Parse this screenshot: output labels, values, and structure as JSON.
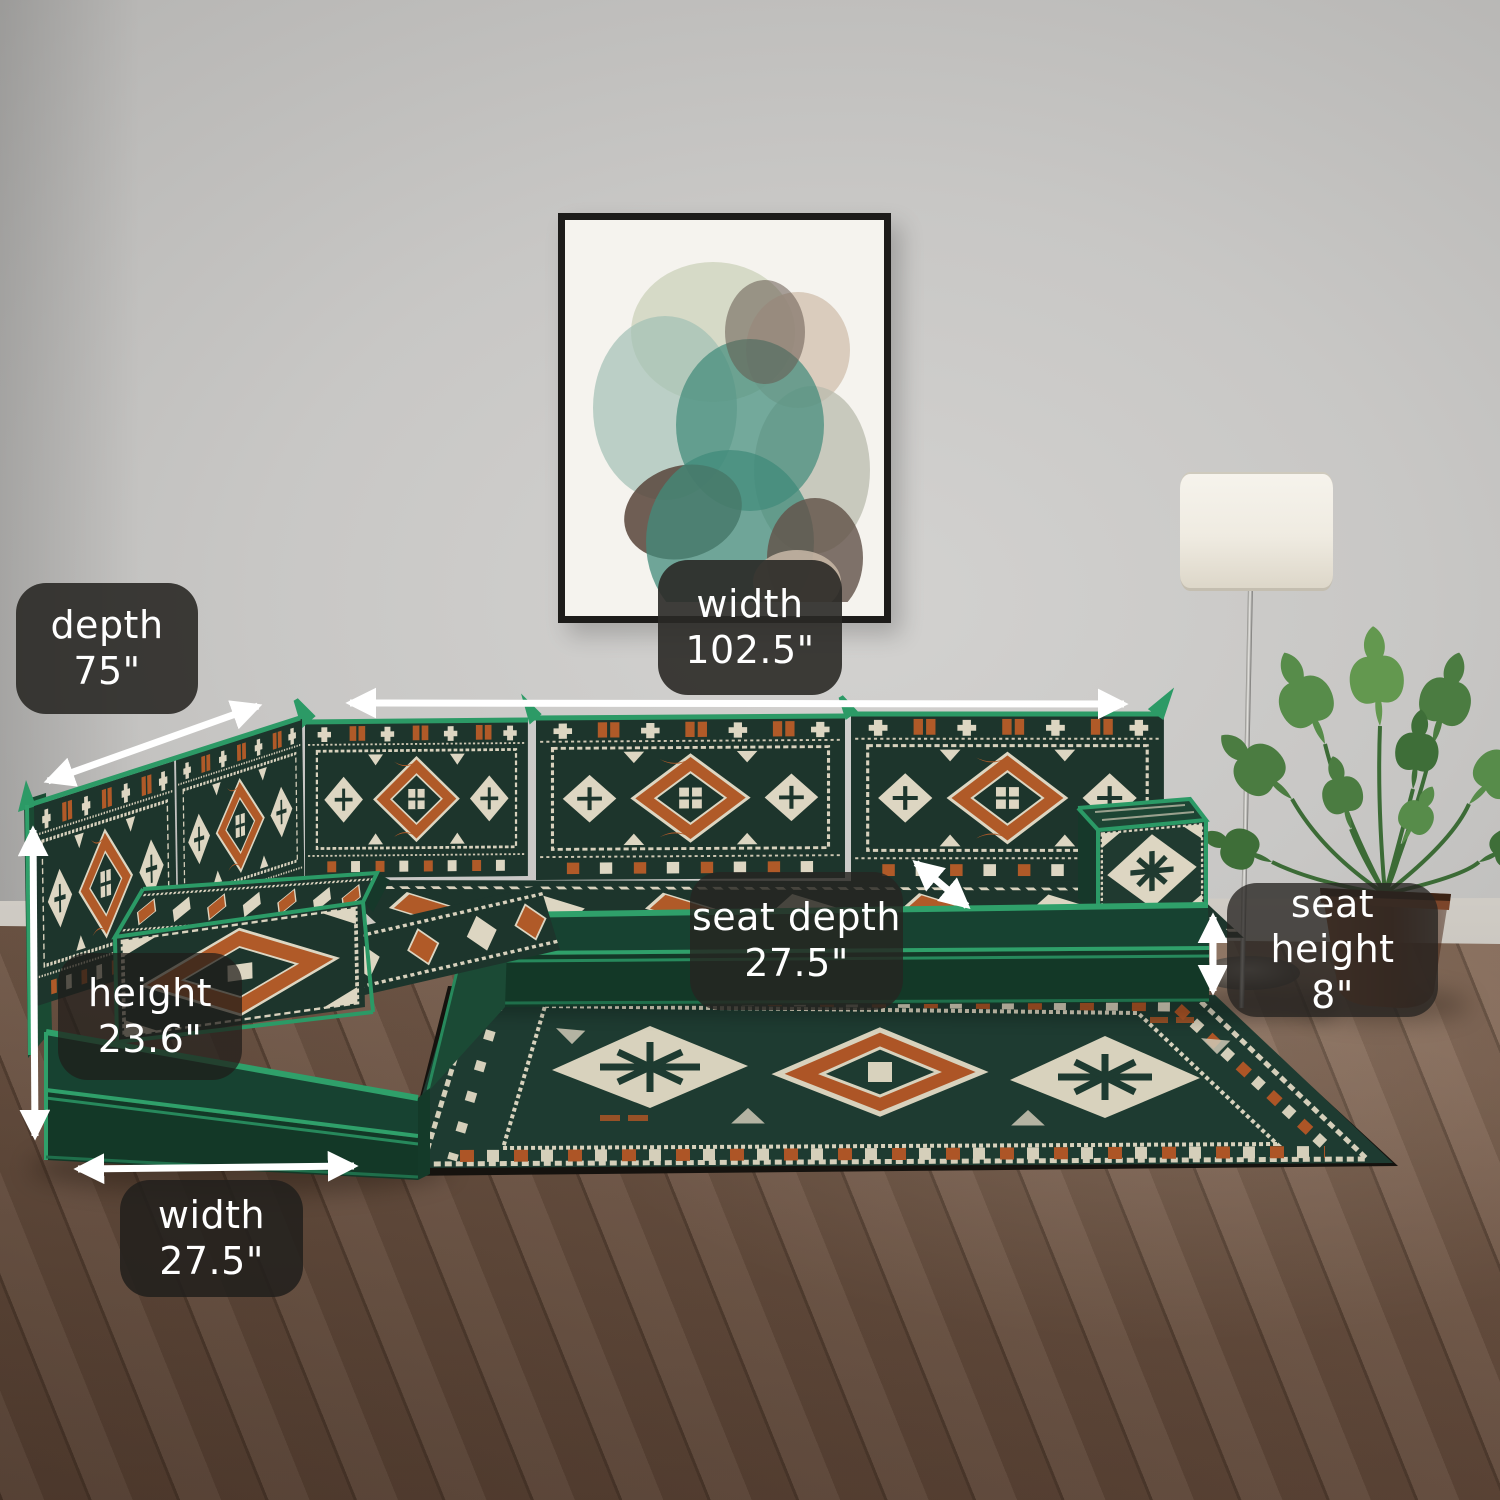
{
  "annotations": {
    "labels": [
      {
        "id": "depth",
        "line1": "depth",
        "line2": "75\""
      },
      {
        "id": "width_top",
        "line1": "width",
        "line2": "102.5\""
      },
      {
        "id": "seat_depth",
        "line1": "seat depth",
        "line2": "27.5\""
      },
      {
        "id": "seat_height",
        "line1": "seat height",
        "line2": "8\""
      },
      {
        "id": "height",
        "line1": "height",
        "line2": "23.6\""
      },
      {
        "id": "width_bottom",
        "line1": "width",
        "line2": "27.5\""
      }
    ],
    "colors": {
      "badge_bg": "#2a2926",
      "badge_text": "#ffffff",
      "arrow": "#ffffff"
    }
  },
  "palette": {
    "wall": "#c8c7c5",
    "floor_wood": "#8f7361",
    "sofa_green": "#174231",
    "piping_green": "#2fa06a",
    "kilim_orange": "#b05a28",
    "kilim_cream": "#ddd6c2",
    "rug_green": "#1e3b31",
    "plant_green": "#578c4a",
    "pot_brown": "#6b3c26"
  }
}
